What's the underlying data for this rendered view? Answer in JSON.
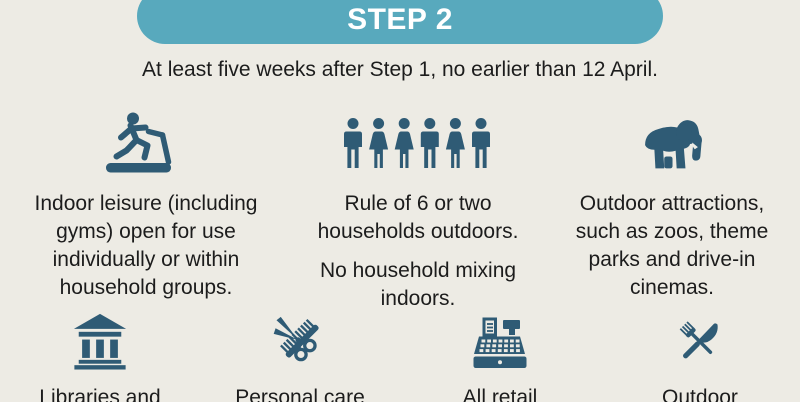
{
  "header": {
    "step_label": "STEP 2"
  },
  "subtitle": "At least five weeks after Step 1, no earlier than 12 April.",
  "colors": {
    "background": "#edebe4",
    "pill_bg": "#58a9bd",
    "pill_text": "#ffffff",
    "icon": "#2f5b75",
    "text": "#1c1c1c"
  },
  "row1": [
    {
      "icon": "treadmill-icon",
      "lines": [
        "Indoor leisure (including",
        "gyms) open for use",
        "individually or within",
        "household groups."
      ]
    },
    {
      "icon": "people-group-icon",
      "paragraphs": [
        [
          "Rule of 6 or two",
          "households outdoors."
        ],
        [
          "No household mixing",
          "indoors."
        ]
      ]
    },
    {
      "icon": "elephant-icon",
      "lines": [
        "Outdoor attractions,",
        "such as zoos, theme",
        "parks and drive-in",
        "cinemas."
      ]
    }
  ],
  "row2": [
    {
      "icon": "library-icon",
      "lines": [
        "Libraries and"
      ]
    },
    {
      "icon": "scissors-comb-icon",
      "lines": [
        "Personal care"
      ]
    },
    {
      "icon": "cash-register-icon",
      "lines": [
        "All retail"
      ]
    },
    {
      "icon": "fork-knife-icon",
      "lines": [
        "Outdoor"
      ]
    }
  ]
}
